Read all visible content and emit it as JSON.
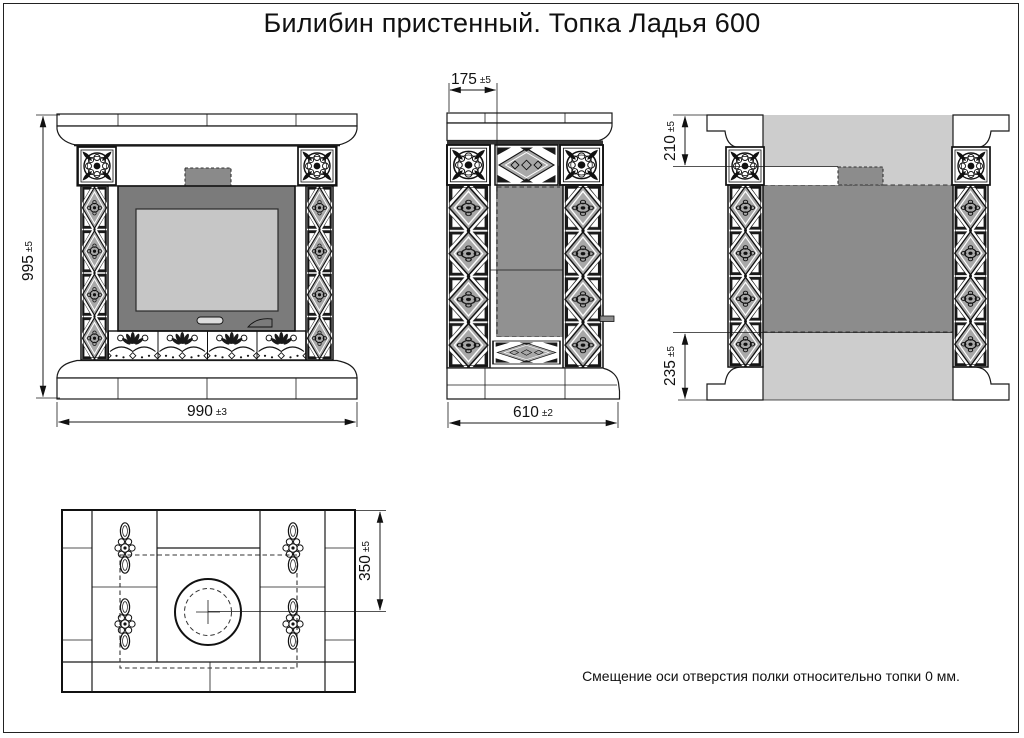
{
  "title": "Билибин пристенный. Топка Ладья 600",
  "note": "Смещение оси отверстия полки относительно топки 0 мм.",
  "dimensions": {
    "front_height": {
      "value": "995",
      "tolerance": "±5"
    },
    "front_width": {
      "value": "990",
      "tolerance": "±3"
    },
    "side_top_offset": {
      "value": "175",
      "tolerance": "±5"
    },
    "side_depth": {
      "value": "610",
      "tolerance": "±2"
    },
    "back_top_offset": {
      "value": "210",
      "tolerance": "±5"
    },
    "back_bottom_offset": {
      "value": "235",
      "tolerance": "±5"
    },
    "plan_hole_offset": {
      "value": "350",
      "tolerance": "±5"
    }
  },
  "views": {
    "front": "front-view",
    "side": "side-view",
    "back": "back-view",
    "plan": "top-plan-view"
  },
  "colors": {
    "line": "#1a1a1a",
    "firebox_front": "#7b7b7b",
    "glass": "#c6c6c6",
    "back_wall": "#cdcdcd",
    "firebox_back": "#8c8c8c",
    "ornament_gray": "#a8a8a8",
    "paper": "#ffffff"
  }
}
